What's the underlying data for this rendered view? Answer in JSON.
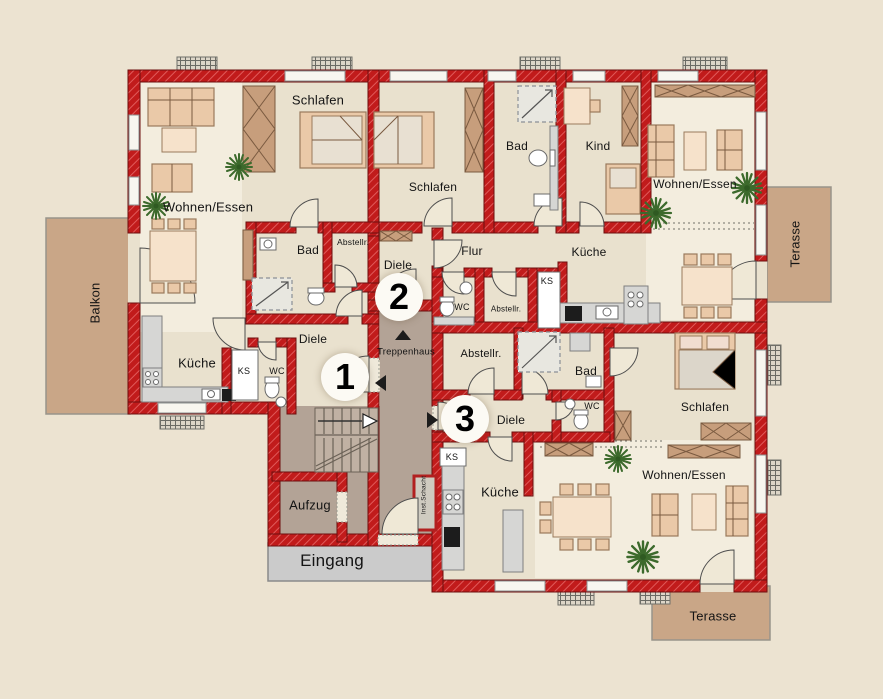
{
  "colors": {
    "background": "#ece3d1",
    "floor": "#e9e1ce",
    "floor_light": "#f3edde",
    "stair_floor": "#b3a396",
    "wall_red": "#c11b1b",
    "terrace_brown": "#c9a687",
    "entrance_gray": "#cbcbcb",
    "furniture_tan": "#eac9a8",
    "plant_green": "#3c6a2c"
  },
  "apartments": [
    {
      "id": "1",
      "rooms": {
        "wohnen_essen": "Wohnen/Essen",
        "schlafen": "Schlafen",
        "bad": "Bad",
        "abstellraum": "Abstellr.",
        "diele": "Diele",
        "kueche": "Küche",
        "wc": "WC",
        "ks": "KS"
      }
    },
    {
      "id": "2",
      "rooms": {
        "schlafen": "Schlafen",
        "bad": "Bad",
        "kind": "Kind",
        "wohnen_essen": "Wohnen/Essen",
        "flur": "Flur",
        "kueche": "Küche",
        "diele": "Diele",
        "wc": "WC",
        "abstellraum": "Abstellr.",
        "ks": "KS"
      }
    },
    {
      "id": "3",
      "rooms": {
        "abstellraum": "Abstellr.",
        "bad": "Bad",
        "schlafen": "Schlafen",
        "diele": "Diele",
        "wc": "WC",
        "kueche": "Küche",
        "ks": "KS",
        "wohnen_essen": "Wohnen/Essen"
      }
    }
  ],
  "common_areas": {
    "treppenhaus": "Treppenhaus",
    "aufzug": "Aufzug",
    "eingang": "Eingang",
    "inst_schacht": "Inst.Schacht"
  },
  "outdoor": {
    "balkon": "Balkon",
    "terasse_right": "Terasse",
    "terasse_bottom": "Terasse"
  }
}
